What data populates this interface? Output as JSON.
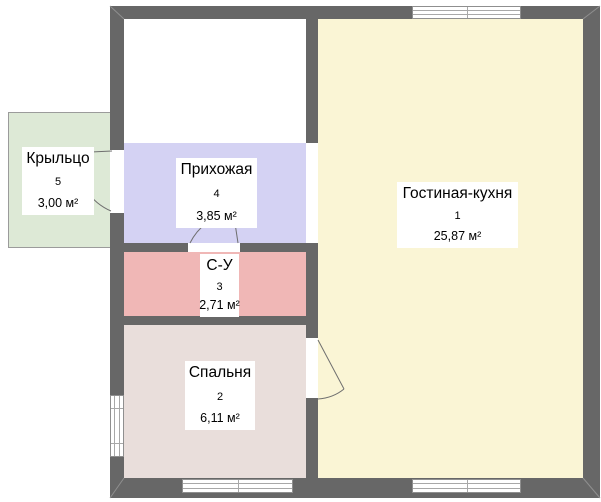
{
  "plan": {
    "title": "floor-plan",
    "background_color": "#ffffff",
    "wall_color": "#676767",
    "rooms": [
      {
        "id": "living",
        "name": "Гостиная-кухня",
        "number": "1",
        "area": "25,87 м²",
        "color": "#faf5d5"
      },
      {
        "id": "bedroom",
        "name": "Спальня",
        "number": "2",
        "area": "6,11 м²",
        "color": "#e9dedb"
      },
      {
        "id": "bathroom",
        "name": "С-У",
        "number": "3",
        "area": "2,71 м²",
        "color": "#f0b7b6"
      },
      {
        "id": "hallway",
        "name": "Прихожая",
        "number": "4",
        "area": "3,85 м²",
        "color": "#d4d2f3"
      },
      {
        "id": "porch",
        "name": "Крыльцо",
        "number": "5",
        "area": "3,00 м²",
        "color": "#dde9d6"
      }
    ]
  }
}
